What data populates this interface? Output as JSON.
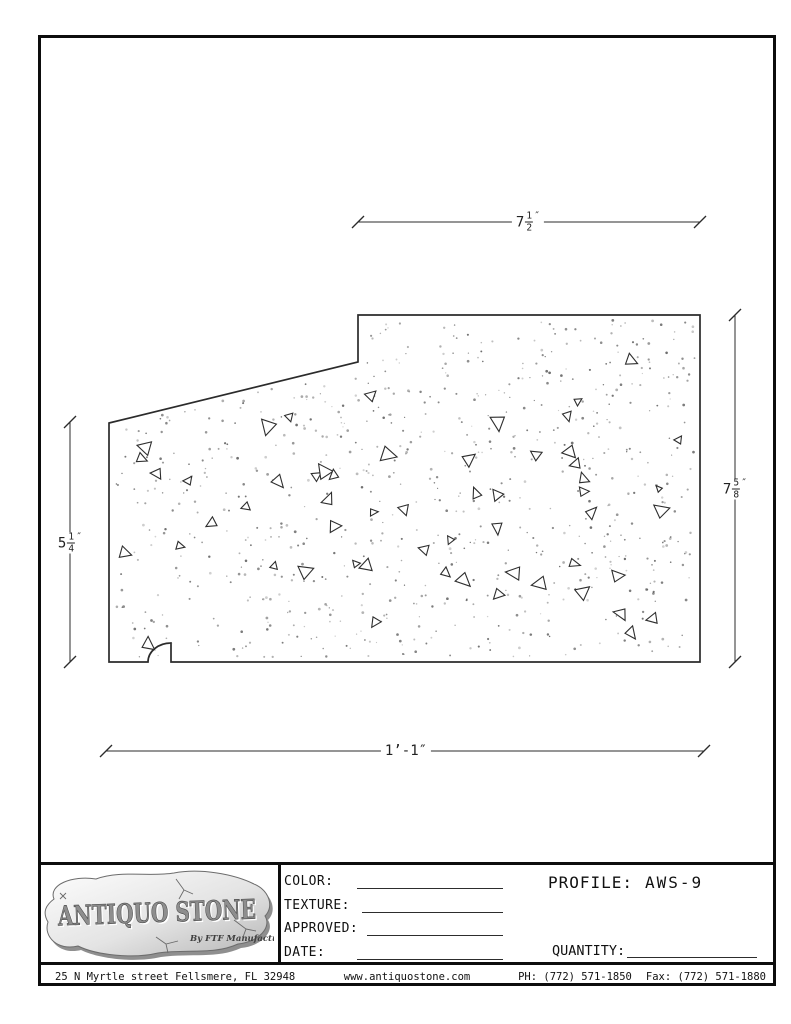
{
  "drawing": {
    "dim_top": {
      "whole": "7",
      "num": "1",
      "den": "2",
      "unit": "″"
    },
    "dim_right": {
      "whole": "7",
      "num": "5",
      "den": "8",
      "unit": "″"
    },
    "dim_left": {
      "whole": "5",
      "num": "1",
      "den": "4",
      "unit": "″"
    },
    "dim_bottom": {
      "text": "1’-1″"
    }
  },
  "title_block": {
    "logo_title": "ANTIQUO STONE",
    "logo_subtitle": "By FTF Manufacturing",
    "fields": [
      {
        "label": "COLOR:"
      },
      {
        "label": "TEXTURE:"
      },
      {
        "label": "APPROVED:"
      },
      {
        "label": "DATE:"
      }
    ],
    "profile_label": "PROFILE:",
    "profile_value": "AWS-9",
    "quantity_label": "QUANTITY:"
  },
  "footer": {
    "address": "25 N Myrtle street Fellsmere, FL 32948",
    "website": "www.antiquostone.com",
    "phone": "PH: (772) 571-1850",
    "fax": "Fax: (772) 571-1880"
  },
  "colors": {
    "line": "#2b2b2b",
    "border": "#0d0d0d",
    "stone_light": "#fdfdfd",
    "stone_dark": "#b5b5b5"
  }
}
